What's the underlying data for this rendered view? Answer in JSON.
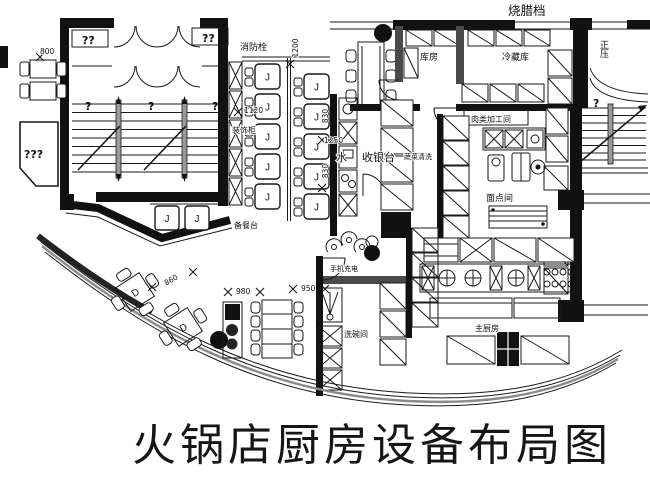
{
  "title": "火锅店厨房设备布局图",
  "plan": {
    "room_labels": [
      {
        "text": "烧腊档"
      },
      {
        "text": "消防栓"
      },
      {
        "text": "库房"
      },
      {
        "text": "冷藏库"
      },
      {
        "text": "正压"
      },
      {
        "text": "肉类加工间"
      },
      {
        "text": "面点间"
      },
      {
        "text": "装饰柜"
      },
      {
        "text": "备餐台"
      },
      {
        "text": "水"
      },
      {
        "text": "收银台"
      },
      {
        "text": "蔬菜清洗"
      },
      {
        "text": "手机充电"
      },
      {
        "text": "洗碗间"
      },
      {
        "text": "主厨房"
      }
    ],
    "dimensions": [
      {
        "text": "1200"
      },
      {
        "text": "1120"
      },
      {
        "text": "1250"
      },
      {
        "text": "830"
      },
      {
        "text": "830"
      },
      {
        "text": "800"
      },
      {
        "text": "860"
      },
      {
        "text": "980"
      },
      {
        "text": "950"
      }
    ],
    "question_marks": [
      {
        "text": "??"
      },
      {
        "text": "??"
      },
      {
        "text": "???"
      },
      {
        "text": "?"
      },
      {
        "text": "?"
      },
      {
        "text": "?"
      },
      {
        "text": "?"
      }
    ],
    "seat_label": "J",
    "table_label": "D",
    "colors": {
      "ink": "#1a1a1a",
      "wall": "#111111",
      "paper": "#ffffff"
    }
  }
}
